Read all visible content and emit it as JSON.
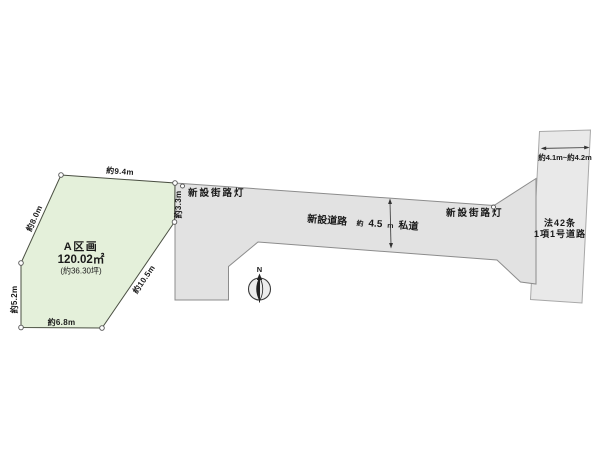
{
  "colors": {
    "background": "#ffffff",
    "parcel_fill": "#e4f0da",
    "parcel_stroke": "#4a4f42",
    "road_fill": "#e2e2e2",
    "road_stroke": "#8c8c8c",
    "public_road_fill": "#e9e9e9",
    "public_road_stroke": "#a8a8a8",
    "dimension_line": "#333333",
    "text": "#1a1a1a"
  },
  "parcel": {
    "name": "A区画",
    "area_m2": "120.02㎡",
    "area_tsubo": "(約36.30坪)",
    "dimensions": {
      "top": "約9.4m",
      "upper_left": "約8.0m",
      "lower_left": "約5.2m",
      "bottom": "約6.8m",
      "diagonal": "約10.5m",
      "road_front": "約3.3m"
    }
  },
  "road": {
    "name": "新設道路",
    "width_approx": "約",
    "width_value": "4.5",
    "width_unit": "m",
    "width_type": "私道"
  },
  "street_lights": {
    "left": "新設街路灯",
    "right": "新設街路灯"
  },
  "public_road": {
    "name_line1": "法42条",
    "name_line2": "1項1号道路",
    "width_range": "約4.1m~約4.2m"
  },
  "compass": {
    "north": "N"
  }
}
